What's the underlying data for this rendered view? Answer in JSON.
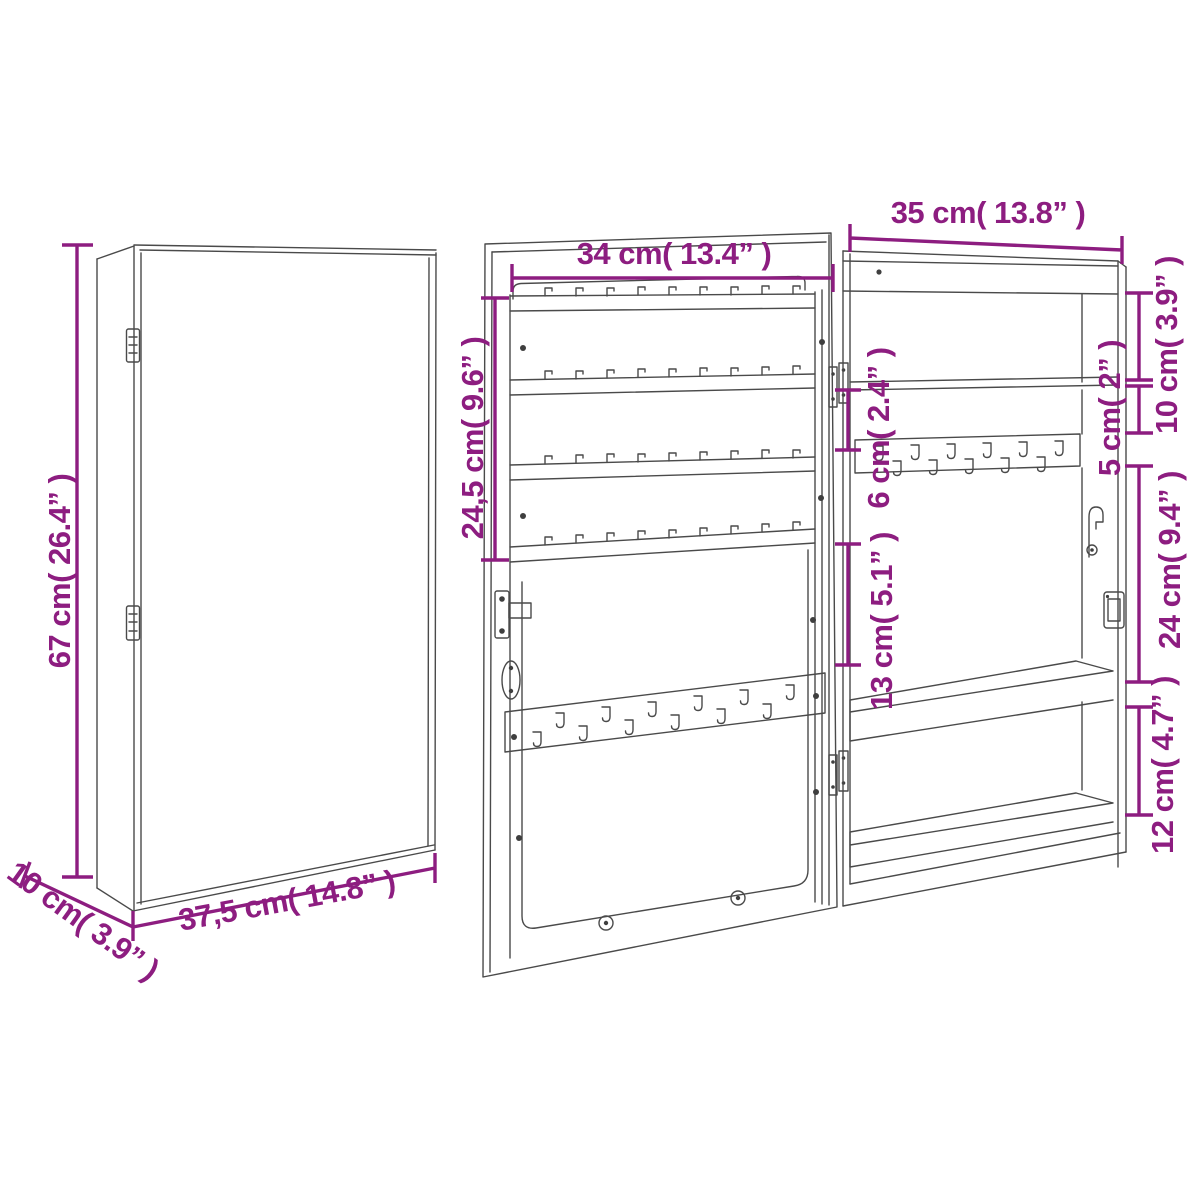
{
  "meta": {
    "type": "furniture-dimension-diagram",
    "subject": "wall-mounted jewelry cabinet with mirror door",
    "background_color": "#ffffff",
    "dimension_color": "#8d1d80",
    "line_color": "#4a4a4a"
  },
  "dims": {
    "closed": {
      "height": "67 cm( 26.4” )",
      "depth": "10 cm( 3.9” )",
      "width": "37,5 cm( 14.8” )"
    },
    "door": {
      "width": "34 cm( 13.4” )",
      "rail_section": "24,5 cm( 9.6” )",
      "hook_gap": "6 cm( 2.4” )",
      "mid_section": "13 cm( 5.1” )"
    },
    "interior": {
      "width": "35 cm( 13.8” )",
      "top": "10 cm( 3.9” )",
      "shelf_gap": "5 cm( 2” )",
      "middle": "24 cm( 9.4” )",
      "bottom": "12 cm( 4.7” )"
    }
  }
}
